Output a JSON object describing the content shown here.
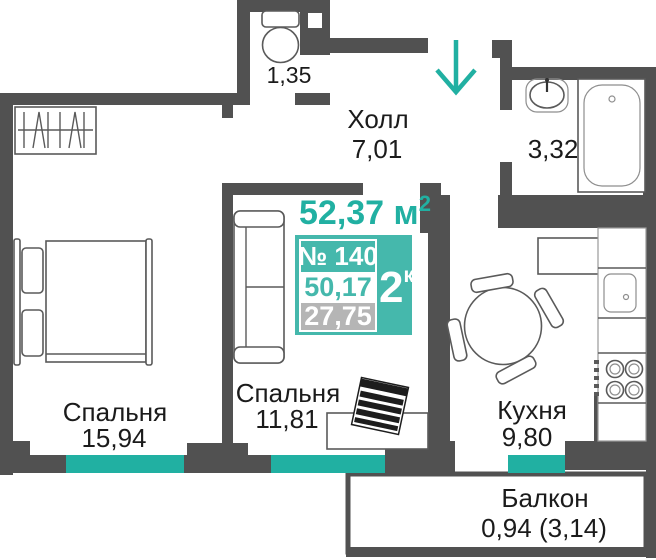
{
  "colors": {
    "wall": "#515151",
    "accent_teal": "#21b0a2",
    "badge_teal": "#45b8ac",
    "badge_gray": "#b5b5b5",
    "text": "#1b1b1b"
  },
  "plan": {
    "total_area": {
      "value": "52,37 м",
      "sup": "2"
    },
    "badge": {
      "number": "№ 140",
      "rooms": "2",
      "rooms_suffix": "к",
      "living_area": "50,17",
      "secondary_area": "27,75"
    },
    "rooms": {
      "hall": {
        "name": "Холл",
        "area": "7,01"
      },
      "wc": {
        "area": "1,35"
      },
      "bathroom": {
        "area": "3,32"
      },
      "bedroom_left": {
        "name": "Спальня",
        "area": "15,94"
      },
      "bedroom_middle": {
        "name": "Спальня",
        "area": "11,81"
      },
      "kitchen": {
        "name": "Кухня",
        "area": "9,80"
      },
      "balcony": {
        "name": "Балкон",
        "area": "0,94 (3,14)"
      }
    }
  }
}
